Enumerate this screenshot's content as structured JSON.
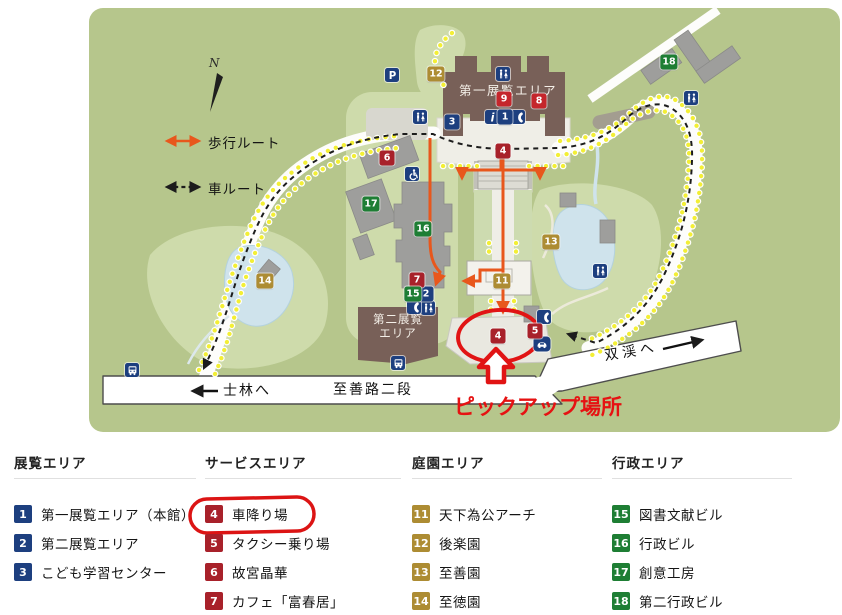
{
  "colors": {
    "map_green": "#b6c68c",
    "pale_green": "#cedbab",
    "road_white": "#ffffff",
    "building_brown": "#786058",
    "building_gray": "#9e9e9c",
    "pond_blue": "#cfe3ec",
    "walking_route_orange": "#e8571c",
    "car_route_black": "#1c1c1c",
    "annotation_red": "#e11414",
    "marker_colors": {
      "blue": "#1d3f7f",
      "red": "#a8212a",
      "crimson": "#c5262c",
      "gold": "#ad8c33",
      "green": "#1e7e34"
    }
  },
  "annotation": {
    "pickup_label": "ピックアップ場所",
    "legend_circled_item": "車降り場"
  },
  "map": {
    "compass": "N",
    "route_legend": {
      "walk": "歩行ルート",
      "car": "車ルート"
    },
    "roads": {
      "shilin": "士林へ",
      "zhishan": "至善路二段",
      "shuangxi": "双渓へ"
    },
    "buildings": {
      "main": "第一展覧エリア",
      "second_line1": "第二展覧",
      "second_line2": "エリア"
    },
    "icon_glyphs": {
      "parking": "P",
      "info": "i"
    },
    "markers": [
      {
        "n": "1",
        "color": "blue",
        "name": "1",
        "x": 505,
        "y": 117
      },
      {
        "n": "2",
        "color": "blue",
        "name": "2",
        "x": 426,
        "y": 294
      },
      {
        "n": "3",
        "color": "blue",
        "name": "3",
        "x": 452,
        "y": 122
      },
      {
        "n": "4",
        "color": "red",
        "name": "4-dropoff",
        "x": 503,
        "y": 151
      },
      {
        "n": "4",
        "color": "red",
        "name": "4-pickup",
        "x": 498,
        "y": 336
      },
      {
        "n": "5",
        "color": "red",
        "name": "5",
        "x": 535,
        "y": 331
      },
      {
        "n": "6",
        "color": "red",
        "name": "6",
        "x": 387,
        "y": 158
      },
      {
        "n": "7",
        "color": "red",
        "name": "7",
        "x": 417,
        "y": 280
      },
      {
        "n": "8",
        "color": "crimson",
        "name": "8",
        "x": 539,
        "y": 101
      },
      {
        "n": "9",
        "color": "crimson",
        "name": "9",
        "x": 504,
        "y": 99
      },
      {
        "n": "11",
        "color": "gold",
        "name": "11",
        "x": 502,
        "y": 281
      },
      {
        "n": "12",
        "color": "gold",
        "name": "12",
        "x": 436,
        "y": 74
      },
      {
        "n": "13",
        "color": "gold",
        "name": "13",
        "x": 551,
        "y": 242
      },
      {
        "n": "14",
        "color": "gold",
        "name": "14",
        "x": 265,
        "y": 281
      },
      {
        "n": "15",
        "color": "green",
        "name": "15",
        "x": 413,
        "y": 294
      },
      {
        "n": "16",
        "color": "green",
        "name": "16",
        "x": 423,
        "y": 229
      },
      {
        "n": "17",
        "color": "green",
        "name": "17",
        "x": 371,
        "y": 204
      },
      {
        "n": "18",
        "color": "green",
        "name": "18",
        "x": 669,
        "y": 62
      }
    ],
    "icons": [
      {
        "type": "parking",
        "x": 392,
        "y": 75
      },
      {
        "type": "restroom",
        "x": 420,
        "y": 117
      },
      {
        "type": "restroom",
        "x": 503,
        "y": 74
      },
      {
        "type": "restroom",
        "x": 691,
        "y": 98
      },
      {
        "type": "restroom",
        "x": 600,
        "y": 271
      },
      {
        "type": "restroom",
        "x": 428,
        "y": 308
      },
      {
        "type": "info",
        "x": 492,
        "y": 117
      },
      {
        "type": "phone",
        "x": 518,
        "y": 117
      },
      {
        "type": "phone",
        "x": 414,
        "y": 307
      },
      {
        "type": "phone",
        "x": 544,
        "y": 317
      },
      {
        "type": "wheelchair",
        "x": 412,
        "y": 174
      },
      {
        "type": "car",
        "x": 542,
        "y": 344
      },
      {
        "type": "bus",
        "x": 398,
        "y": 363
      },
      {
        "type": "bus",
        "x": 132,
        "y": 370
      }
    ]
  },
  "legend": {
    "sections": [
      {
        "title": "展覧エリア",
        "color": "blue",
        "items": [
          {
            "num": "1",
            "label": "第一展覧エリア（本館）"
          },
          {
            "num": "2",
            "label": "第二展覧エリア"
          },
          {
            "num": "3",
            "label": "こども学習センター"
          }
        ]
      },
      {
        "title": "サービスエリア",
        "color": "red",
        "items": [
          {
            "num": "4",
            "label": "車降り場",
            "circled": true
          },
          {
            "num": "5",
            "label": "タクシー乗り場"
          },
          {
            "num": "6",
            "label": "故宮晶華"
          },
          {
            "num": "7",
            "label": "カフェ「富春居」"
          }
        ]
      },
      {
        "title": "庭園エリア",
        "color": "gold",
        "items": [
          {
            "num": "11",
            "label": "天下為公アーチ"
          },
          {
            "num": "12",
            "label": "後楽園"
          },
          {
            "num": "13",
            "label": "至善園"
          },
          {
            "num": "14",
            "label": "至徳園"
          }
        ]
      },
      {
        "title": "行政エリア",
        "color": "green",
        "items": [
          {
            "num": "15",
            "label": "図書文献ビル"
          },
          {
            "num": "16",
            "label": "行政ビル"
          },
          {
            "num": "17",
            "label": "創意工房"
          },
          {
            "num": "18",
            "label": "第二行政ビル"
          }
        ]
      }
    ]
  }
}
